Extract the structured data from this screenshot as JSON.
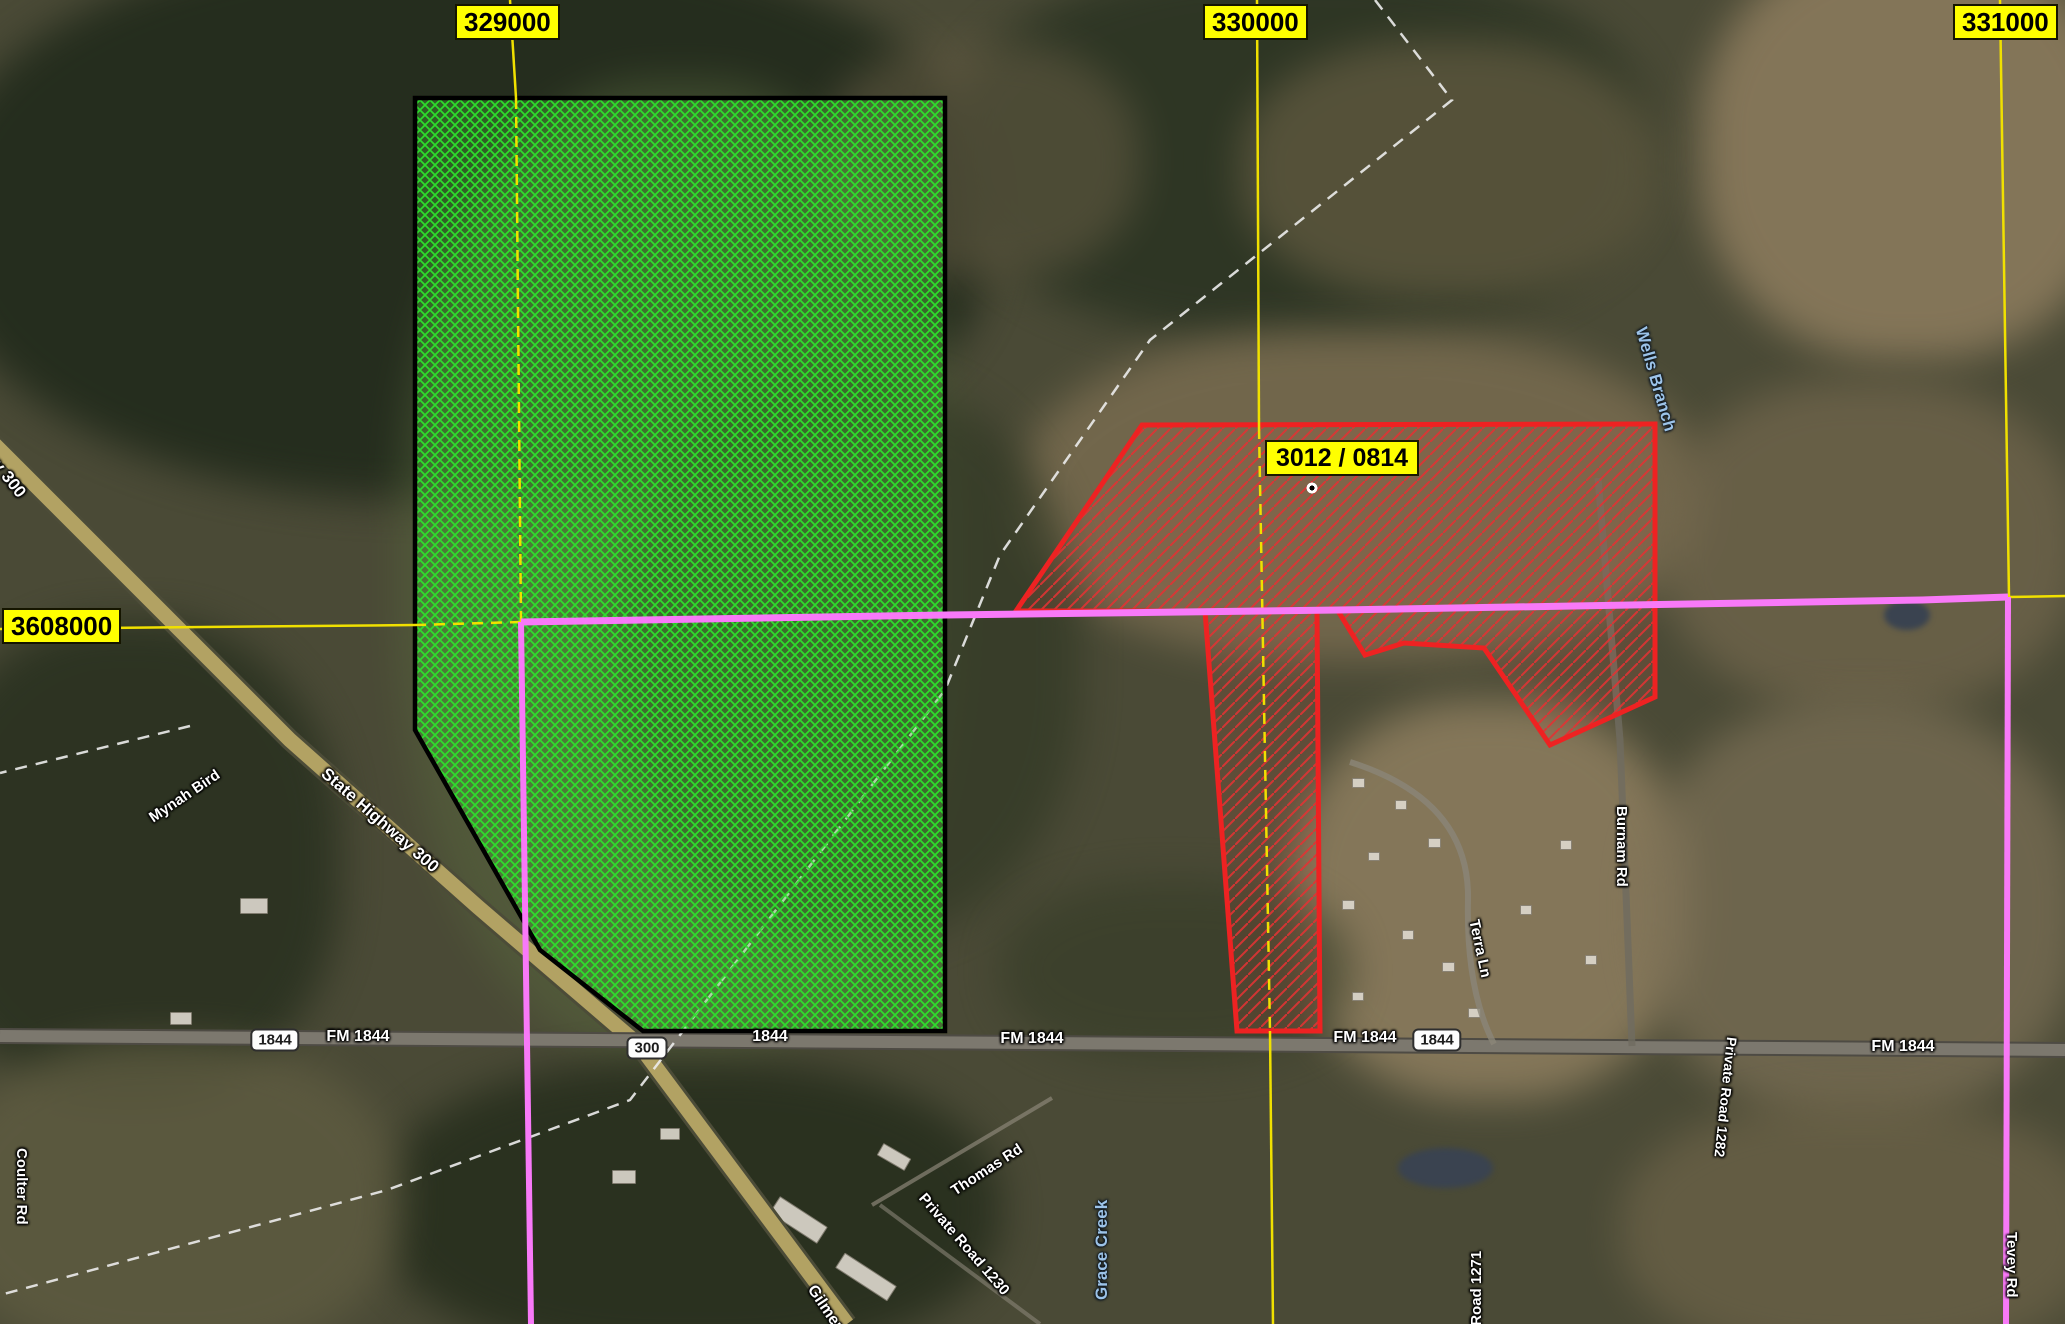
{
  "map": {
    "grid_labels": {
      "meridian_329000": "329000",
      "meridian_330000": "330000",
      "meridian_331000": "331000",
      "parallel_3608000": "3608000"
    },
    "parcel": {
      "red_parcel_label": "3012 / 0814"
    },
    "road_labels": {
      "state_highway_300_upper": "State Highway 300",
      "state_highway_300_lower": "State Highway 300",
      "mynah_bird": "Mynah Bird",
      "coulter_rd": "Coulter Rd",
      "fm_1844_a": "FM 1844",
      "fm_1844_b": "FM 1844",
      "fm_1844_c": "FM 1844",
      "fm_1844_d": "FM 1844",
      "fm_1844_short": "1844",
      "thomas_rd": "Thomas Rd",
      "private_road_1230": "Private Road 1230",
      "private_road_1271": "Private Road 1271",
      "private_road_1282": "Private Road 1282",
      "terra_ln": "Terra Ln",
      "burnam_rd": "Burnam Rd",
      "tevey_rd": "Tevey Rd",
      "gilmer_rd": "Gilmer Rd"
    },
    "water_labels": {
      "grace_creek": "Grace Creek",
      "wells_branch_lower": "Wells Branch",
      "wells_branch_top": "Wells Branch"
    },
    "shields": {
      "sh_300": "300",
      "fm_1844_west": "1844",
      "fm_1844_east": "1844"
    },
    "colors": {
      "grid_yellow": "#f0e000",
      "parcel_green_hatch": "#2ce32c",
      "parcel_red": "#ee2222",
      "boundary_pink": "#f879f8",
      "water_label_blue": "#9cc3e8"
    }
  }
}
